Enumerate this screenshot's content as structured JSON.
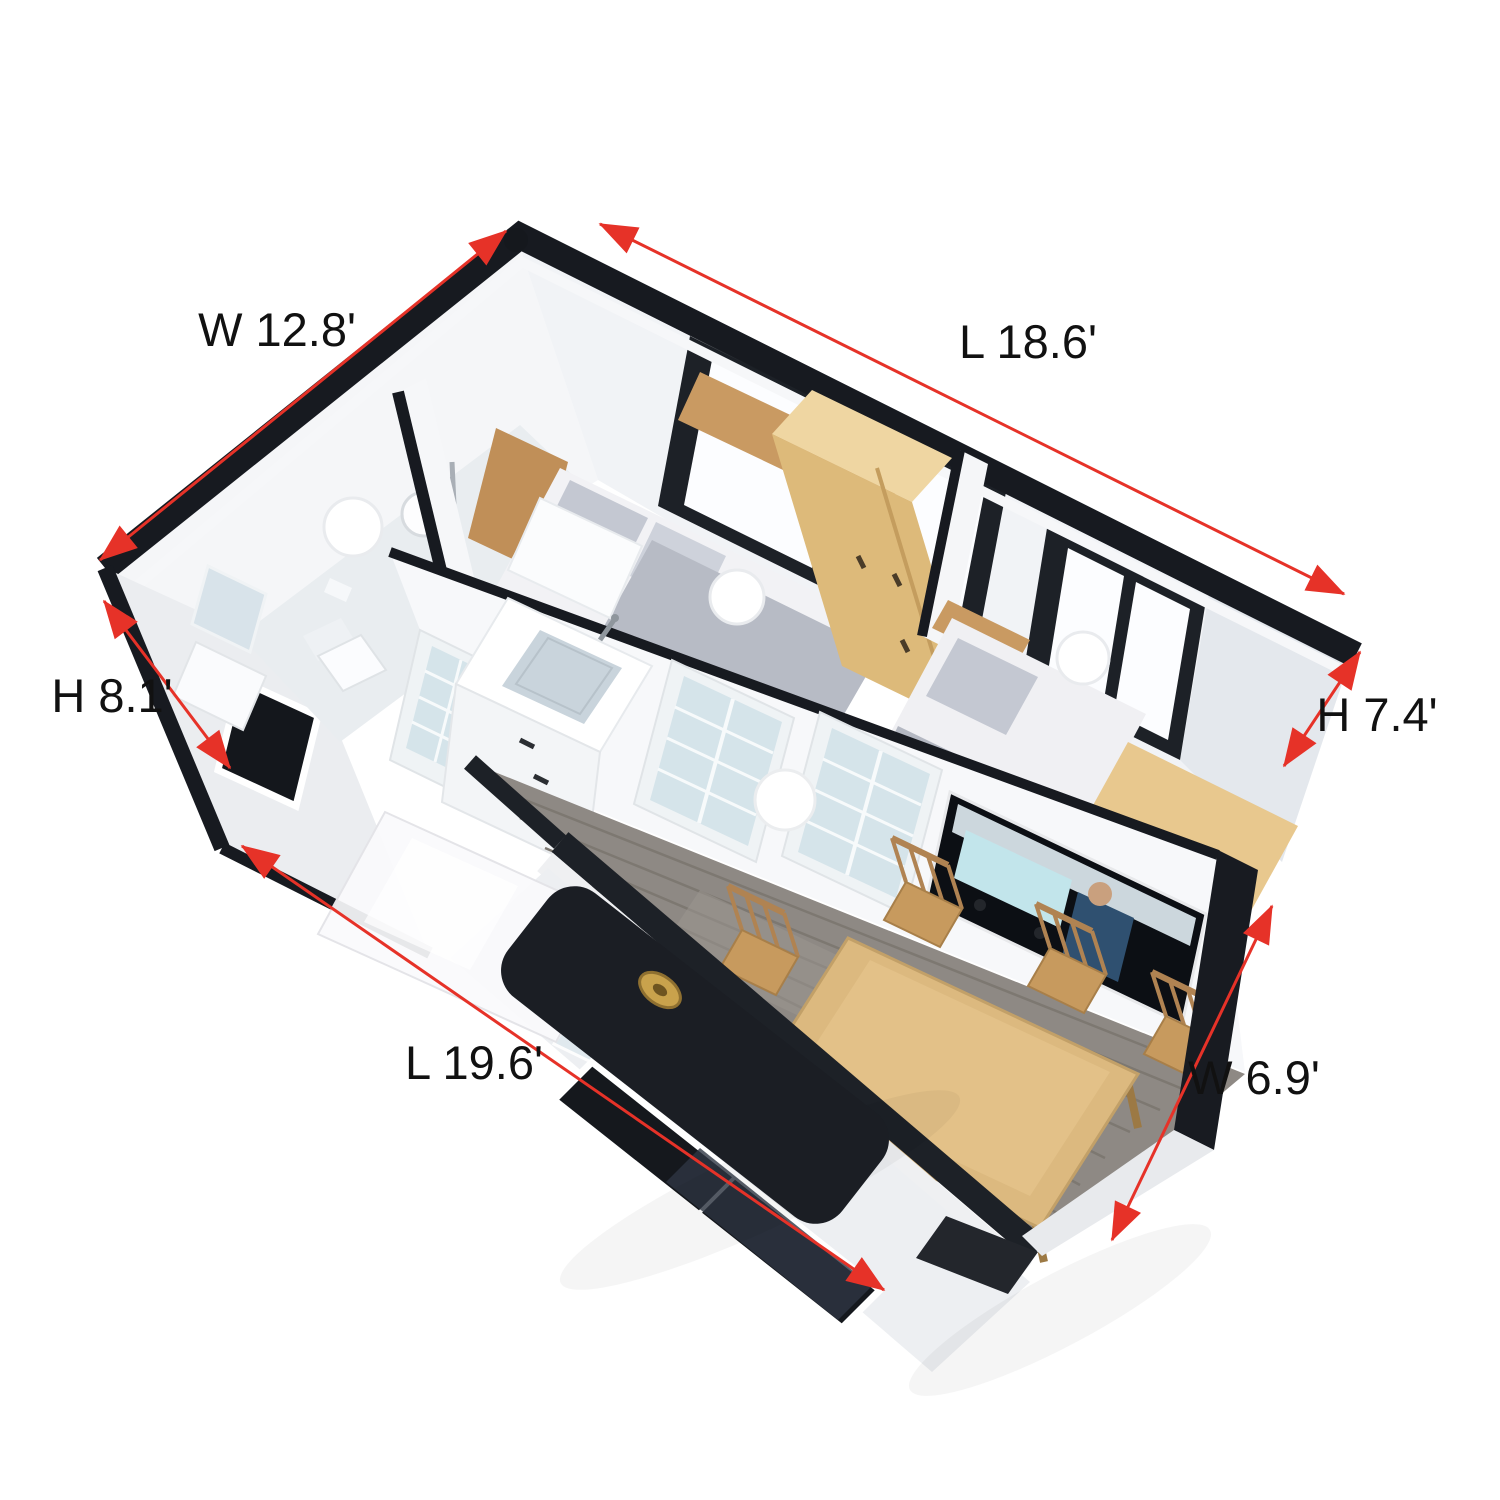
{
  "annotations": {
    "width_total": {
      "label": "W 12.8'"
    },
    "length_back": {
      "label": "L 18.6'"
    },
    "height_back": {
      "label": "H 8.1'"
    },
    "height_front": {
      "label": "H 7.4'"
    },
    "length_front": {
      "label": "L 19.6'"
    },
    "width_front": {
      "label": "W 6.9'"
    }
  },
  "colors": {
    "dimension_red": "#e63228",
    "frame_black": "#171a20",
    "wall_white": "#f4f5f7",
    "wood_light": "#efd6a2",
    "wood_mid": "#dcb97f",
    "floor_gray": "#8e8984",
    "glass_frost": "#d5e4ea",
    "bedding_gray": "#c4c8d2"
  }
}
